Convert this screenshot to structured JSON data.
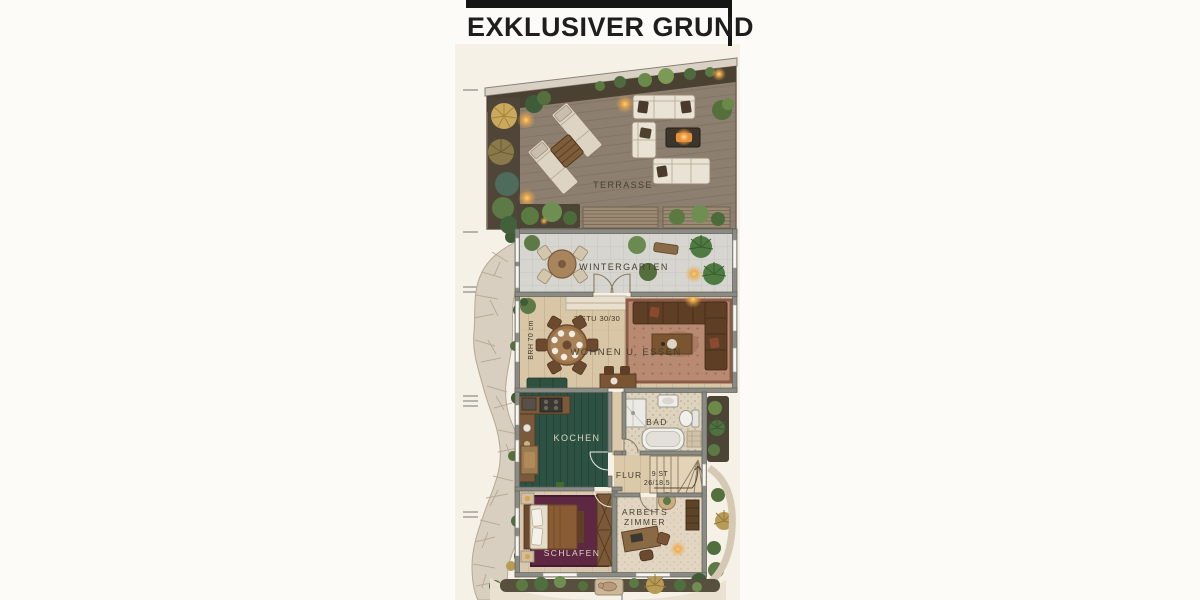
{
  "header": {
    "title": "EXKLUSIVER GRUND"
  },
  "floorplan": {
    "rooms": {
      "terrasse": "TERRASSE",
      "wintergarten": "WINTERGARTEN",
      "wohnen_essen": "WOHNEN U. ESSEN",
      "kochen": "KOCHEN",
      "bad": "BAD",
      "flur": "FLUR",
      "schlafen": "SCHLAFEN",
      "arbeitszimmer_line1": "ARBEITS",
      "arbeitszimmer_line2": "ZIMMER"
    },
    "annotations": {
      "wintergarten_steps": "2 STU 30/30",
      "window_sill_height": "BRH 70 cm",
      "stairs_count": "9 ST",
      "stairs_dimension": "26/18.5"
    },
    "colors": {
      "title_bar": "#161616",
      "paper": "#f6f1e7",
      "terrace_deck": "#8d7f6f",
      "wintergarten_tile": "#d6d5d0",
      "wood_floor": "#d9c6a6",
      "kitchen_floor": "#2d5244",
      "bedroom_rug": "#5e2742",
      "living_rug": "#b98a72",
      "wall": "#8b8b85",
      "stone_path": "#d9cfc0"
    }
  }
}
